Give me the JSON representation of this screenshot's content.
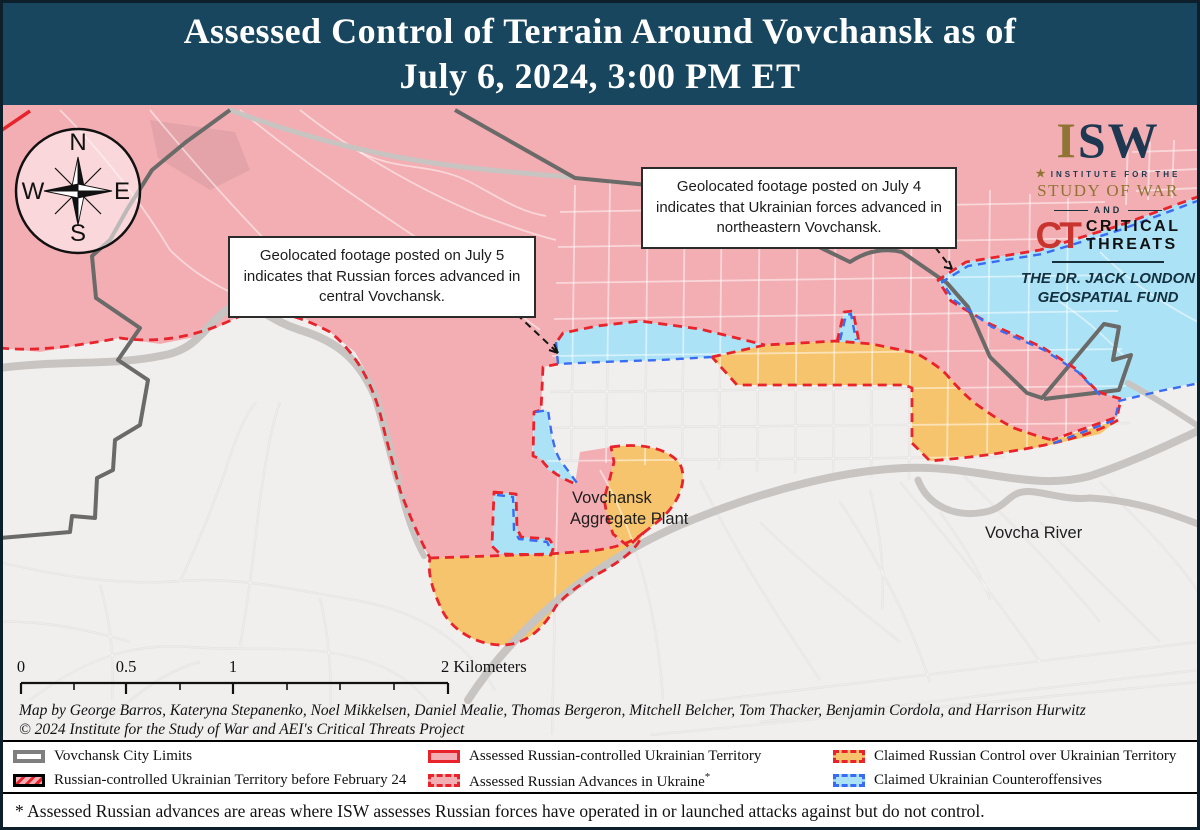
{
  "title": {
    "line1": "Assessed Control of Terrain Around Vovchansk as of",
    "line2": "July 6, 2024, 3:00 PM ET"
  },
  "compass": {
    "n": "N",
    "e": "E",
    "s": "S",
    "w": "W"
  },
  "logo": {
    "isw_i": "I",
    "isw_sw": "SW",
    "star": "★",
    "institute": "INSTITUTE FOR THE",
    "study": "STUDY OF WAR",
    "and": "AND",
    "ct": "CT",
    "critical": "CRITICAL",
    "threats": "THREATS",
    "fund_line1": "THE DR. JACK LONDON",
    "fund_line2": "GEOSPATIAL FUND"
  },
  "callouts": {
    "july5": "Geolocated footage posted on July 5 indicates that Russian forces advanced in central Vovchansk.",
    "july4": "Geolocated footage posted on July 4 indicates that Ukrainian forces advanced in northeastern Vovchansk."
  },
  "map_labels": {
    "plant_line1": "Vovchansk",
    "plant_line2": "Aggregate Plant",
    "river": "Vovcha River"
  },
  "scale_bar": {
    "t0": "0",
    "t05": "0.5",
    "t1": "1",
    "t2": "2 Kilometers"
  },
  "attribution": {
    "line1": "Map by George Barros, Kateryna Stepanenko, Noel Mikkelsen, Daniel Mealie, Thomas Bergeron, Mitchell Belcher, Tom Thacker, Benjamin Cordola, and Harrison Hurwitz",
    "line2": "© 2024 Institute for the Study of War and AEI's Critical Threats Project"
  },
  "legend": {
    "items": [
      {
        "label": "Vovchansk City Limits"
      },
      {
        "label": "Russian-controlled Ukrainian Territory before February 24"
      },
      {
        "label": "Assessed Russian-controlled Ukrainian Territory"
      },
      {
        "label": "Assessed Russian Advances in Ukraine",
        "sup": "*"
      },
      {
        "label": "Claimed Russian Control over Ukrainian Territory"
      },
      {
        "label": "Claimed Ukrainian Counteroffensives"
      }
    ]
  },
  "footnote": "* Assessed Russian advances are areas where ISW assesses Russian forces have operated in or launched attacks against but do not control.",
  "colors": {
    "title_bg": "#17465e",
    "assessed_russian_control": "#f3aeb3",
    "claimed_russian_control": "#f6c46d",
    "claimed_ukrainian_counteroffensive": "#abe2f6",
    "russian_line_red": "#e8232b",
    "ukrainian_line_blue": "#3a6cf3",
    "city_limits_gray": "#6a6a68",
    "map_background": "#f1efee"
  }
}
